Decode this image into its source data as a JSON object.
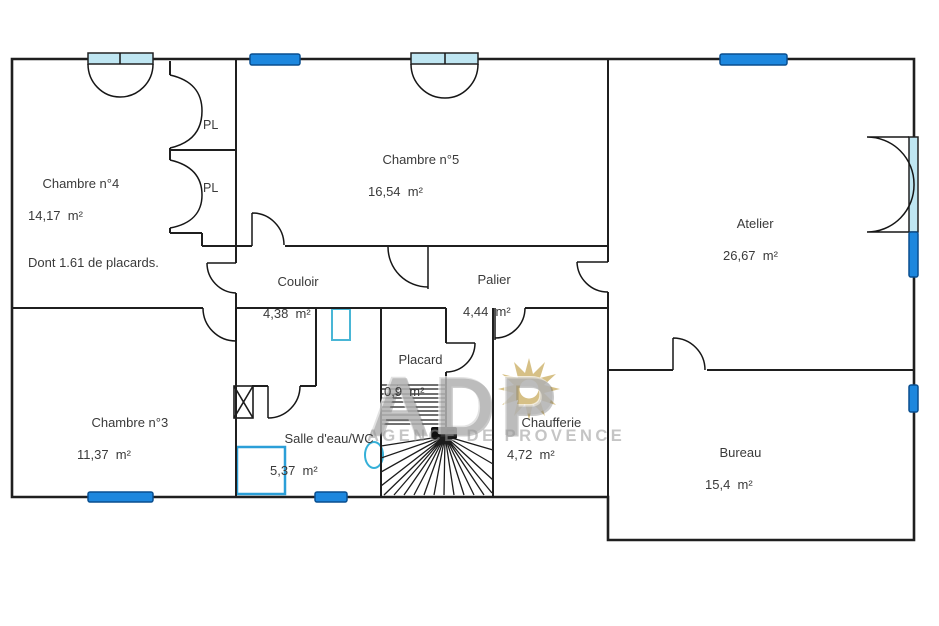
{
  "watermark": {
    "initials": "ADP",
    "agency": "AGENCE DE PROVENCE",
    "sun_color": "#cdb168",
    "text_color": "#969696"
  },
  "colors": {
    "wall": "#222222",
    "window_fill": "#1d87de",
    "window_stroke": "#0a4f8f",
    "glazing_fill": "#bfe6f2",
    "fixture_blue": "#3fb0dc"
  },
  "rooms": [
    {
      "id": "chambre4",
      "name": "Chambre n°4",
      "area": "14,17  m²",
      "note": "Dont 1.61 de placards."
    },
    {
      "id": "chambre5",
      "name": "Chambre n°5",
      "area": "16,54  m²"
    },
    {
      "id": "atelier",
      "name": "Atelier",
      "area": "26,67  m²"
    },
    {
      "id": "couloir",
      "name": "Couloir",
      "area": "4,38  m²"
    },
    {
      "id": "palier",
      "name": "Palier",
      "area": "4,44  m²"
    },
    {
      "id": "placard",
      "name": "Placard",
      "area": "0,9  m²"
    },
    {
      "id": "chambre3",
      "name": "Chambre n°3",
      "area": "11,37  m²"
    },
    {
      "id": "salle_eau",
      "name": "Salle d'eau/WC",
      "area": "5,37  m²"
    },
    {
      "id": "chaufferie",
      "name": "Chaufferie",
      "area": "4,72  m²"
    },
    {
      "id": "bureau",
      "name": "Bureau",
      "area": "15,4  m²"
    }
  ],
  "closets": {
    "label": "PL"
  }
}
